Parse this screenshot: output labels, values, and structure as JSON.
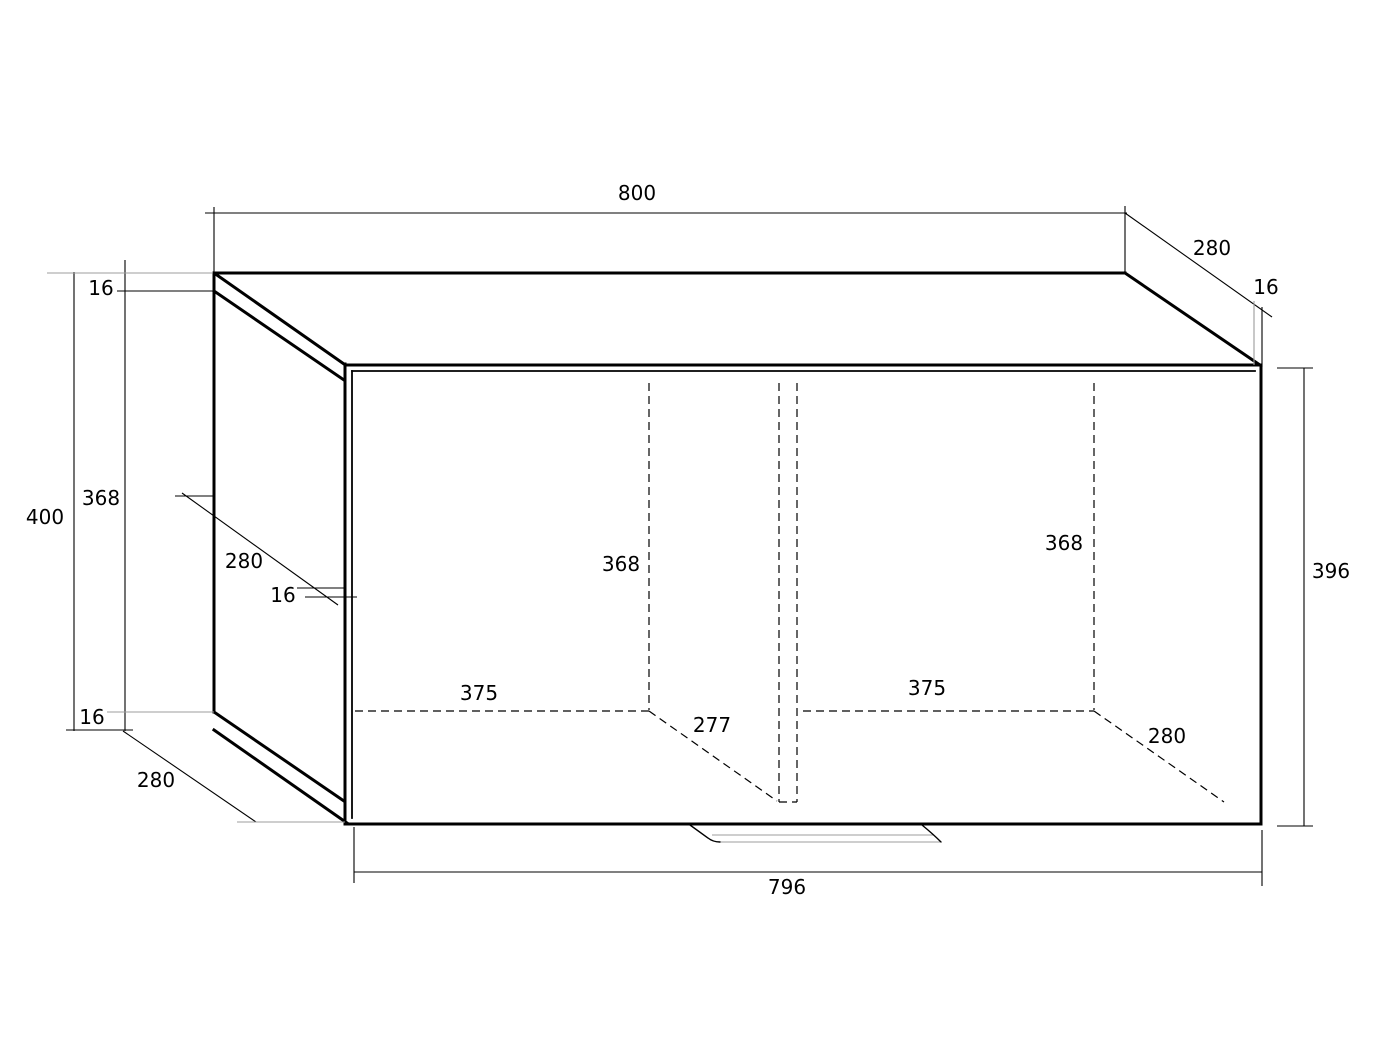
{
  "drawing": {
    "title": "cabinet-dimension-drawing",
    "canvas": {
      "width": 1397,
      "height": 1047
    },
    "colors": {
      "background": "#ffffff",
      "line": "#000000",
      "extension": "#9c9c9c"
    },
    "dimensions_summary": {
      "overall_width": 800,
      "overall_depth": 280,
      "overall_height": 400,
      "panel_thickness": 16,
      "side_panel_height": 368,
      "side_panel_depth": 280,
      "door_width": 796,
      "door_height": 396,
      "compartment_width": 375,
      "compartment_height": 368,
      "left_compartment_depth": 277,
      "right_compartment_depth": 280
    },
    "labels": [
      {
        "id": "overall-width",
        "text": "800",
        "x": 637,
        "y": 200
      },
      {
        "id": "overall-depth-top-right",
        "text": "280",
        "x": 1212,
        "y": 255
      },
      {
        "id": "thickness-top-right",
        "text": "16",
        "x": 1266,
        "y": 294
      },
      {
        "id": "thickness-top-left",
        "text": "16",
        "x": 101,
        "y": 295
      },
      {
        "id": "overall-height",
        "text": "400",
        "x": 45,
        "y": 524
      },
      {
        "id": "side-panel-height",
        "text": "368",
        "x": 101,
        "y": 505
      },
      {
        "id": "side-panel-depth",
        "text": "280",
        "x": 244,
        "y": 568
      },
      {
        "id": "thickness-side-front",
        "text": "16",
        "x": 283,
        "y": 602
      },
      {
        "id": "thickness-bottom-left",
        "text": "16",
        "x": 92,
        "y": 724
      },
      {
        "id": "depth-bottom-left",
        "text": "280",
        "x": 156,
        "y": 787
      },
      {
        "id": "left-compartment-height",
        "text": "368",
        "x": 621,
        "y": 571
      },
      {
        "id": "left-compartment-width",
        "text": "375",
        "x": 479,
        "y": 700
      },
      {
        "id": "left-compartment-depth",
        "text": "277",
        "x": 712,
        "y": 732
      },
      {
        "id": "right-compartment-height",
        "text": "368",
        "x": 1064,
        "y": 550
      },
      {
        "id": "right-compartment-width",
        "text": "375",
        "x": 927,
        "y": 695
      },
      {
        "id": "right-compartment-depth",
        "text": "280",
        "x": 1167,
        "y": 743
      },
      {
        "id": "door-height",
        "text": "396",
        "x": 1331,
        "y": 578
      },
      {
        "id": "door-width",
        "text": "796",
        "x": 787,
        "y": 894
      }
    ],
    "lines": [
      {
        "name": "top-back-edge",
        "kind": "edge",
        "x1": 214,
        "y1": 273,
        "x2": 1125,
        "y2": 273
      },
      {
        "name": "top-face-right-edge",
        "kind": "edge",
        "x1": 1125,
        "y1": 273,
        "x2": 1260,
        "y2": 365
      },
      {
        "name": "top-face-left-edge",
        "kind": "edge",
        "x1": 214,
        "y1": 273,
        "x2": 344,
        "y2": 364
      },
      {
        "name": "top-joint-left-edge",
        "kind": "edge",
        "x1": 214,
        "y1": 291,
        "x2": 344,
        "y2": 380
      },
      {
        "name": "side-panel-back-edge",
        "kind": "edge",
        "x1": 214,
        "y1": 273,
        "x2": 214,
        "y2": 712
      },
      {
        "name": "side-panel-bottom-edge",
        "kind": "edge",
        "x1": 214,
        "y1": 712,
        "x2": 344,
        "y2": 801
      },
      {
        "name": "bottom-panel-left-edge",
        "kind": "edge",
        "x1": 214,
        "y1": 730,
        "x2": 347,
        "y2": 823
      },
      {
        "name": "door-left-edge",
        "kind": "edge",
        "x1": 345,
        "y1": 364,
        "x2": 345,
        "y2": 822
      },
      {
        "name": "door-top-edge",
        "kind": "edge",
        "x1": 345,
        "y1": 365,
        "x2": 1261,
        "y2": 365
      },
      {
        "name": "door-right-edge",
        "kind": "edge",
        "x1": 1261,
        "y1": 365,
        "x2": 1261,
        "y2": 824
      },
      {
        "name": "door-bottom-edge",
        "kind": "edge",
        "x1": 345,
        "y1": 824,
        "x2": 1261,
        "y2": 824
      },
      {
        "name": "door-left-inner-line",
        "kind": "edge2",
        "x1": 352,
        "y1": 371,
        "x2": 352,
        "y2": 818
      },
      {
        "name": "door-top-inner-line",
        "kind": "edge2",
        "x1": 352,
        "y1": 371,
        "x2": 1255,
        "y2": 371
      },
      {
        "name": "dim-800-line",
        "kind": "dim",
        "x1": 205,
        "y1": 213,
        "x2": 1127,
        "y2": 213
      },
      {
        "name": "dim-800-ext-left",
        "kind": "dim",
        "x1": 214,
        "y1": 207,
        "x2": 214,
        "y2": 272
      },
      {
        "name": "dim-800-ext-right",
        "kind": "dim",
        "x1": 1125,
        "y1": 206,
        "x2": 1125,
        "y2": 272
      },
      {
        "name": "dim-280-top-right-line",
        "kind": "dim",
        "x1": 1125,
        "y1": 213,
        "x2": 1272,
        "y2": 317
      },
      {
        "name": "dim-16-top-right-ext",
        "kind": "dim",
        "x1": 1262,
        "y1": 307,
        "x2": 1262,
        "y2": 367
      },
      {
        "name": "dim-400-line",
        "kind": "dim",
        "x1": 74,
        "y1": 272,
        "x2": 74,
        "y2": 731
      },
      {
        "name": "dim-368-line",
        "kind": "dim",
        "x1": 125,
        "y1": 260,
        "x2": 125,
        "y2": 731
      },
      {
        "name": "dim-16-top-left-ext",
        "kind": "dim",
        "x1": 117,
        "y1": 291,
        "x2": 213,
        "y2": 291
      },
      {
        "name": "dim-bottom-connector",
        "kind": "dim",
        "x1": 66,
        "y1": 730,
        "x2": 133,
        "y2": 730
      },
      {
        "name": "dim-280-bottom-left-line",
        "kind": "dim",
        "x1": 123,
        "y1": 731,
        "x2": 256,
        "y2": 822
      },
      {
        "name": "dim-280-side-line",
        "kind": "dim",
        "x1": 182,
        "y1": 493,
        "x2": 338,
        "y2": 605
      },
      {
        "name": "dim-280-side-leader",
        "kind": "dim",
        "x1": 175,
        "y1": 496,
        "x2": 213,
        "y2": 496
      },
      {
        "name": "dim-16-side-leader-upper",
        "kind": "dim",
        "x1": 297,
        "y1": 588,
        "x2": 344,
        "y2": 588
      },
      {
        "name": "dim-16-side-leader-lower",
        "kind": "dim",
        "x1": 305,
        "y1": 597,
        "x2": 357,
        "y2": 597
      },
      {
        "name": "dim-396-line",
        "kind": "dim",
        "x1": 1304,
        "y1": 368,
        "x2": 1304,
        "y2": 826
      },
      {
        "name": "dim-396-tick-top",
        "kind": "dim",
        "x1": 1277,
        "y1": 368,
        "x2": 1313,
        "y2": 368
      },
      {
        "name": "dim-396-tick-bottom",
        "kind": "dim",
        "x1": 1277,
        "y1": 826,
        "x2": 1313,
        "y2": 826
      },
      {
        "name": "dim-796-line",
        "kind": "dim",
        "x1": 354,
        "y1": 872,
        "x2": 1262,
        "y2": 872
      },
      {
        "name": "dim-796-ext-left",
        "kind": "dim",
        "x1": 354,
        "y1": 827,
        "x2": 354,
        "y2": 883
      },
      {
        "name": "dim-796-ext-right",
        "kind": "dim",
        "x1": 1262,
        "y1": 830,
        "x2": 1262,
        "y2": 886
      },
      {
        "name": "ext-top-left-gray",
        "kind": "gray",
        "x1": 47,
        "y1": 273,
        "x2": 213,
        "y2": 273
      },
      {
        "name": "ext-bottom-left-gray",
        "kind": "gray",
        "x1": 107,
        "y1": 712,
        "x2": 214,
        "y2": 712
      },
      {
        "name": "ext-bottom-280-gray",
        "kind": "gray",
        "x1": 237,
        "y1": 822,
        "x2": 345,
        "y2": 822
      },
      {
        "name": "ext-16-top-right-gray",
        "kind": "gray",
        "x1": 1254,
        "y1": 301,
        "x2": 1254,
        "y2": 365
      },
      {
        "name": "handle-upper-line",
        "kind": "gray",
        "x1": 712,
        "y1": 835,
        "x2": 933,
        "y2": 835
      },
      {
        "name": "handle-lower-line",
        "kind": "gray",
        "x1": 719,
        "y1": 842,
        "x2": 940,
        "y2": 842
      },
      {
        "name": "hidden-left-compartment-height",
        "kind": "dash",
        "x1": 649,
        "y1": 383,
        "x2": 649,
        "y2": 710
      },
      {
        "name": "hidden-left-compartment-width",
        "kind": "dash",
        "x1": 355,
        "y1": 711,
        "x2": 649,
        "y2": 711
      },
      {
        "name": "hidden-left-compartment-depth",
        "kind": "dash",
        "x1": 649,
        "y1": 711,
        "x2": 777,
        "y2": 801
      },
      {
        "name": "hidden-divider-left-edge",
        "kind": "dash",
        "x1": 779,
        "y1": 383,
        "x2": 779,
        "y2": 802
      },
      {
        "name": "hidden-divider-right-edge",
        "kind": "dash",
        "x1": 797,
        "y1": 383,
        "x2": 797,
        "y2": 802
      },
      {
        "name": "hidden-divider-bottom-edge",
        "kind": "dash",
        "x1": 779,
        "y1": 802,
        "x2": 797,
        "y2": 802
      },
      {
        "name": "hidden-right-compartment-height",
        "kind": "dash",
        "x1": 1094,
        "y1": 383,
        "x2": 1094,
        "y2": 710
      },
      {
        "name": "hidden-right-compartment-width",
        "kind": "dash",
        "x1": 803,
        "y1": 711,
        "x2": 1094,
        "y2": 711
      },
      {
        "name": "hidden-right-compartment-depth",
        "kind": "dash",
        "x1": 1094,
        "y1": 711,
        "x2": 1224,
        "y2": 802
      }
    ],
    "paths": [
      {
        "name": "handle-left-end",
        "d": "M 690 825 L 708 838 Q 713 842 720 842"
      },
      {
        "name": "handle-right-end",
        "d": "M 922 825 Q 933 834 941 842"
      }
    ]
  }
}
